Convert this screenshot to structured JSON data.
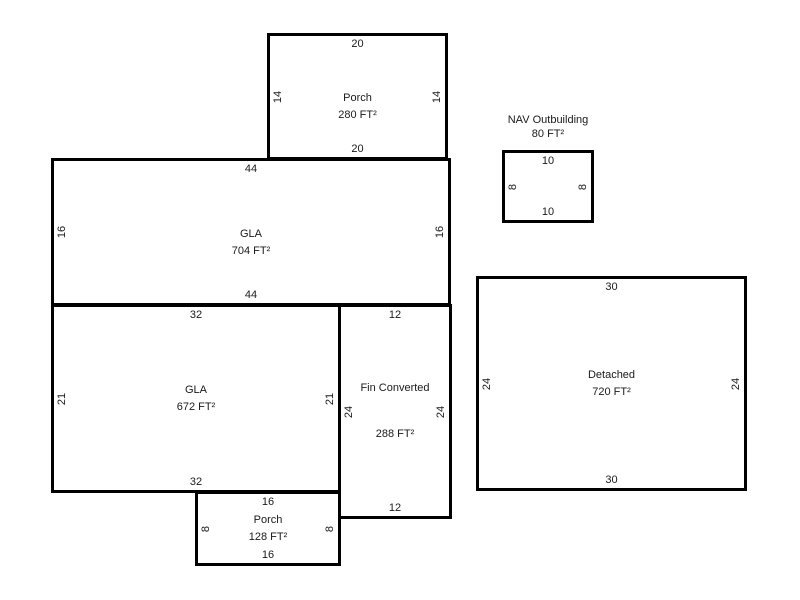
{
  "diagram": {
    "type": "floor-plan-sketch",
    "background_color": "#ffffff",
    "line_color": "#000000",
    "text_color": "#1a1a1a",
    "rooms": [
      {
        "id": "porch-top",
        "name": "Porch",
        "area": "280 FT²",
        "dims": {
          "top": "20",
          "bottom": "20",
          "left": "14",
          "right": "14"
        }
      },
      {
        "id": "gla-main",
        "name": "GLA",
        "area": "704 FT²",
        "dims": {
          "top": "44",
          "bottom": "44",
          "left": "16",
          "right": "16"
        }
      },
      {
        "id": "gla-lower",
        "name": "GLA",
        "area": "672 FT²",
        "dims": {
          "top": "32",
          "bottom": "32",
          "left": "21",
          "right": "21"
        }
      },
      {
        "id": "fin-converted",
        "name": "Fin Converted",
        "area": "288 FT²",
        "dims": {
          "top": "12",
          "bottom": "12",
          "left": "24",
          "right": "24"
        }
      },
      {
        "id": "porch-bottom",
        "name": "Porch",
        "area": "128 FT²",
        "dims": {
          "top": "16",
          "bottom": "16",
          "left": "8",
          "right": "8"
        }
      },
      {
        "id": "nav-outbuilding",
        "name": "NAV Outbuilding",
        "area": "80 FT²",
        "label_position": "above",
        "dims": {
          "top": "10",
          "bottom": "10",
          "left": "8",
          "right": "8"
        }
      },
      {
        "id": "detached",
        "name": "Detached",
        "area": "720 FT²",
        "dims": {
          "top": "30",
          "bottom": "30",
          "left": "24",
          "right": "24"
        }
      }
    ]
  }
}
